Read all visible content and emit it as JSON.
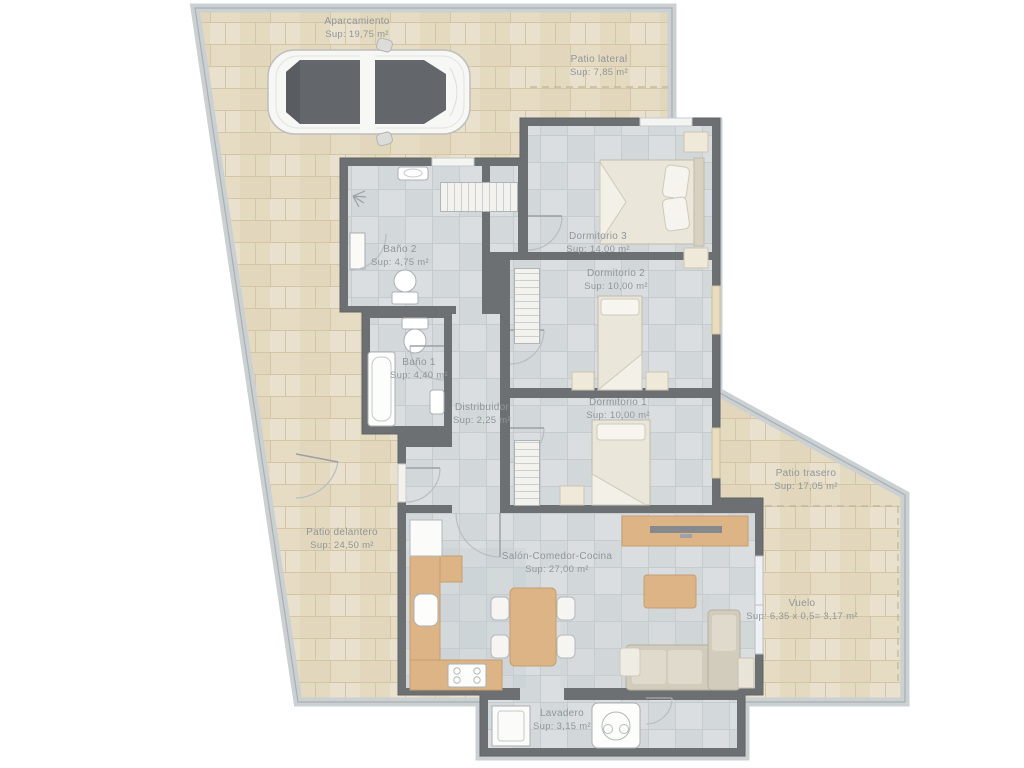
{
  "plan_title": "Vivienda - plano de planta",
  "rooms": [
    {
      "id": "aparcamiento",
      "name": "Aparcamiento",
      "area": "Sup: 19,75 m²"
    },
    {
      "id": "patio-lateral",
      "name": "Patio lateral",
      "area": "Sup: 7,85 m²"
    },
    {
      "id": "bano-2",
      "name": "Baño 2",
      "area": "Sup: 4,75 m²"
    },
    {
      "id": "dormitorio-3",
      "name": "Dormitorio 3",
      "area": "Sup: 14,00 m²"
    },
    {
      "id": "dormitorio-2",
      "name": "Dormitorio 2",
      "area": "Sup: 10,00 m²"
    },
    {
      "id": "bano-1",
      "name": "Baño 1",
      "area": "Sup: 4,40 m²"
    },
    {
      "id": "distribuidor",
      "name": "Distribuidor",
      "area": "Sup: 2,25 m²"
    },
    {
      "id": "dormitorio-1",
      "name": "Dormitorio 1",
      "area": "Sup: 10,00 m²"
    },
    {
      "id": "patio-trasero",
      "name": "Patio trasero",
      "area": "Sup: 17,05 m²"
    },
    {
      "id": "patio-delantero",
      "name": "Patio delantero",
      "area": "Sup: 24,50 m²"
    },
    {
      "id": "salon-comedor-cocina",
      "name": "Salón-Comedor-Cocina",
      "area": "Sup: 27,00 m²"
    },
    {
      "id": "vuelo",
      "name": "Vuelo",
      "area": "Sup: 6,35 x 0,5= 3,17 m²"
    },
    {
      "id": "lavadero",
      "name": "Lavadero",
      "area": "Sup: 3,15 m²"
    }
  ],
  "icons": {
    "car": "top-view-car",
    "washing_machine": "drum-circle",
    "shower": "spray-fan",
    "toilet": "bowl-and-tank",
    "bathtub": "rounded-tub"
  },
  "palette": {
    "wall": "#6d7073",
    "boundary": "#cbd0d2",
    "patio_tile": "#e6ddc6",
    "patio_grout": "#d3c6a6",
    "floor_tile": "#d8dcdf",
    "floor_grid": "#c6cbce",
    "wood": "#ddb486",
    "glass": "#63676c",
    "label_text": "#8f969a"
  }
}
